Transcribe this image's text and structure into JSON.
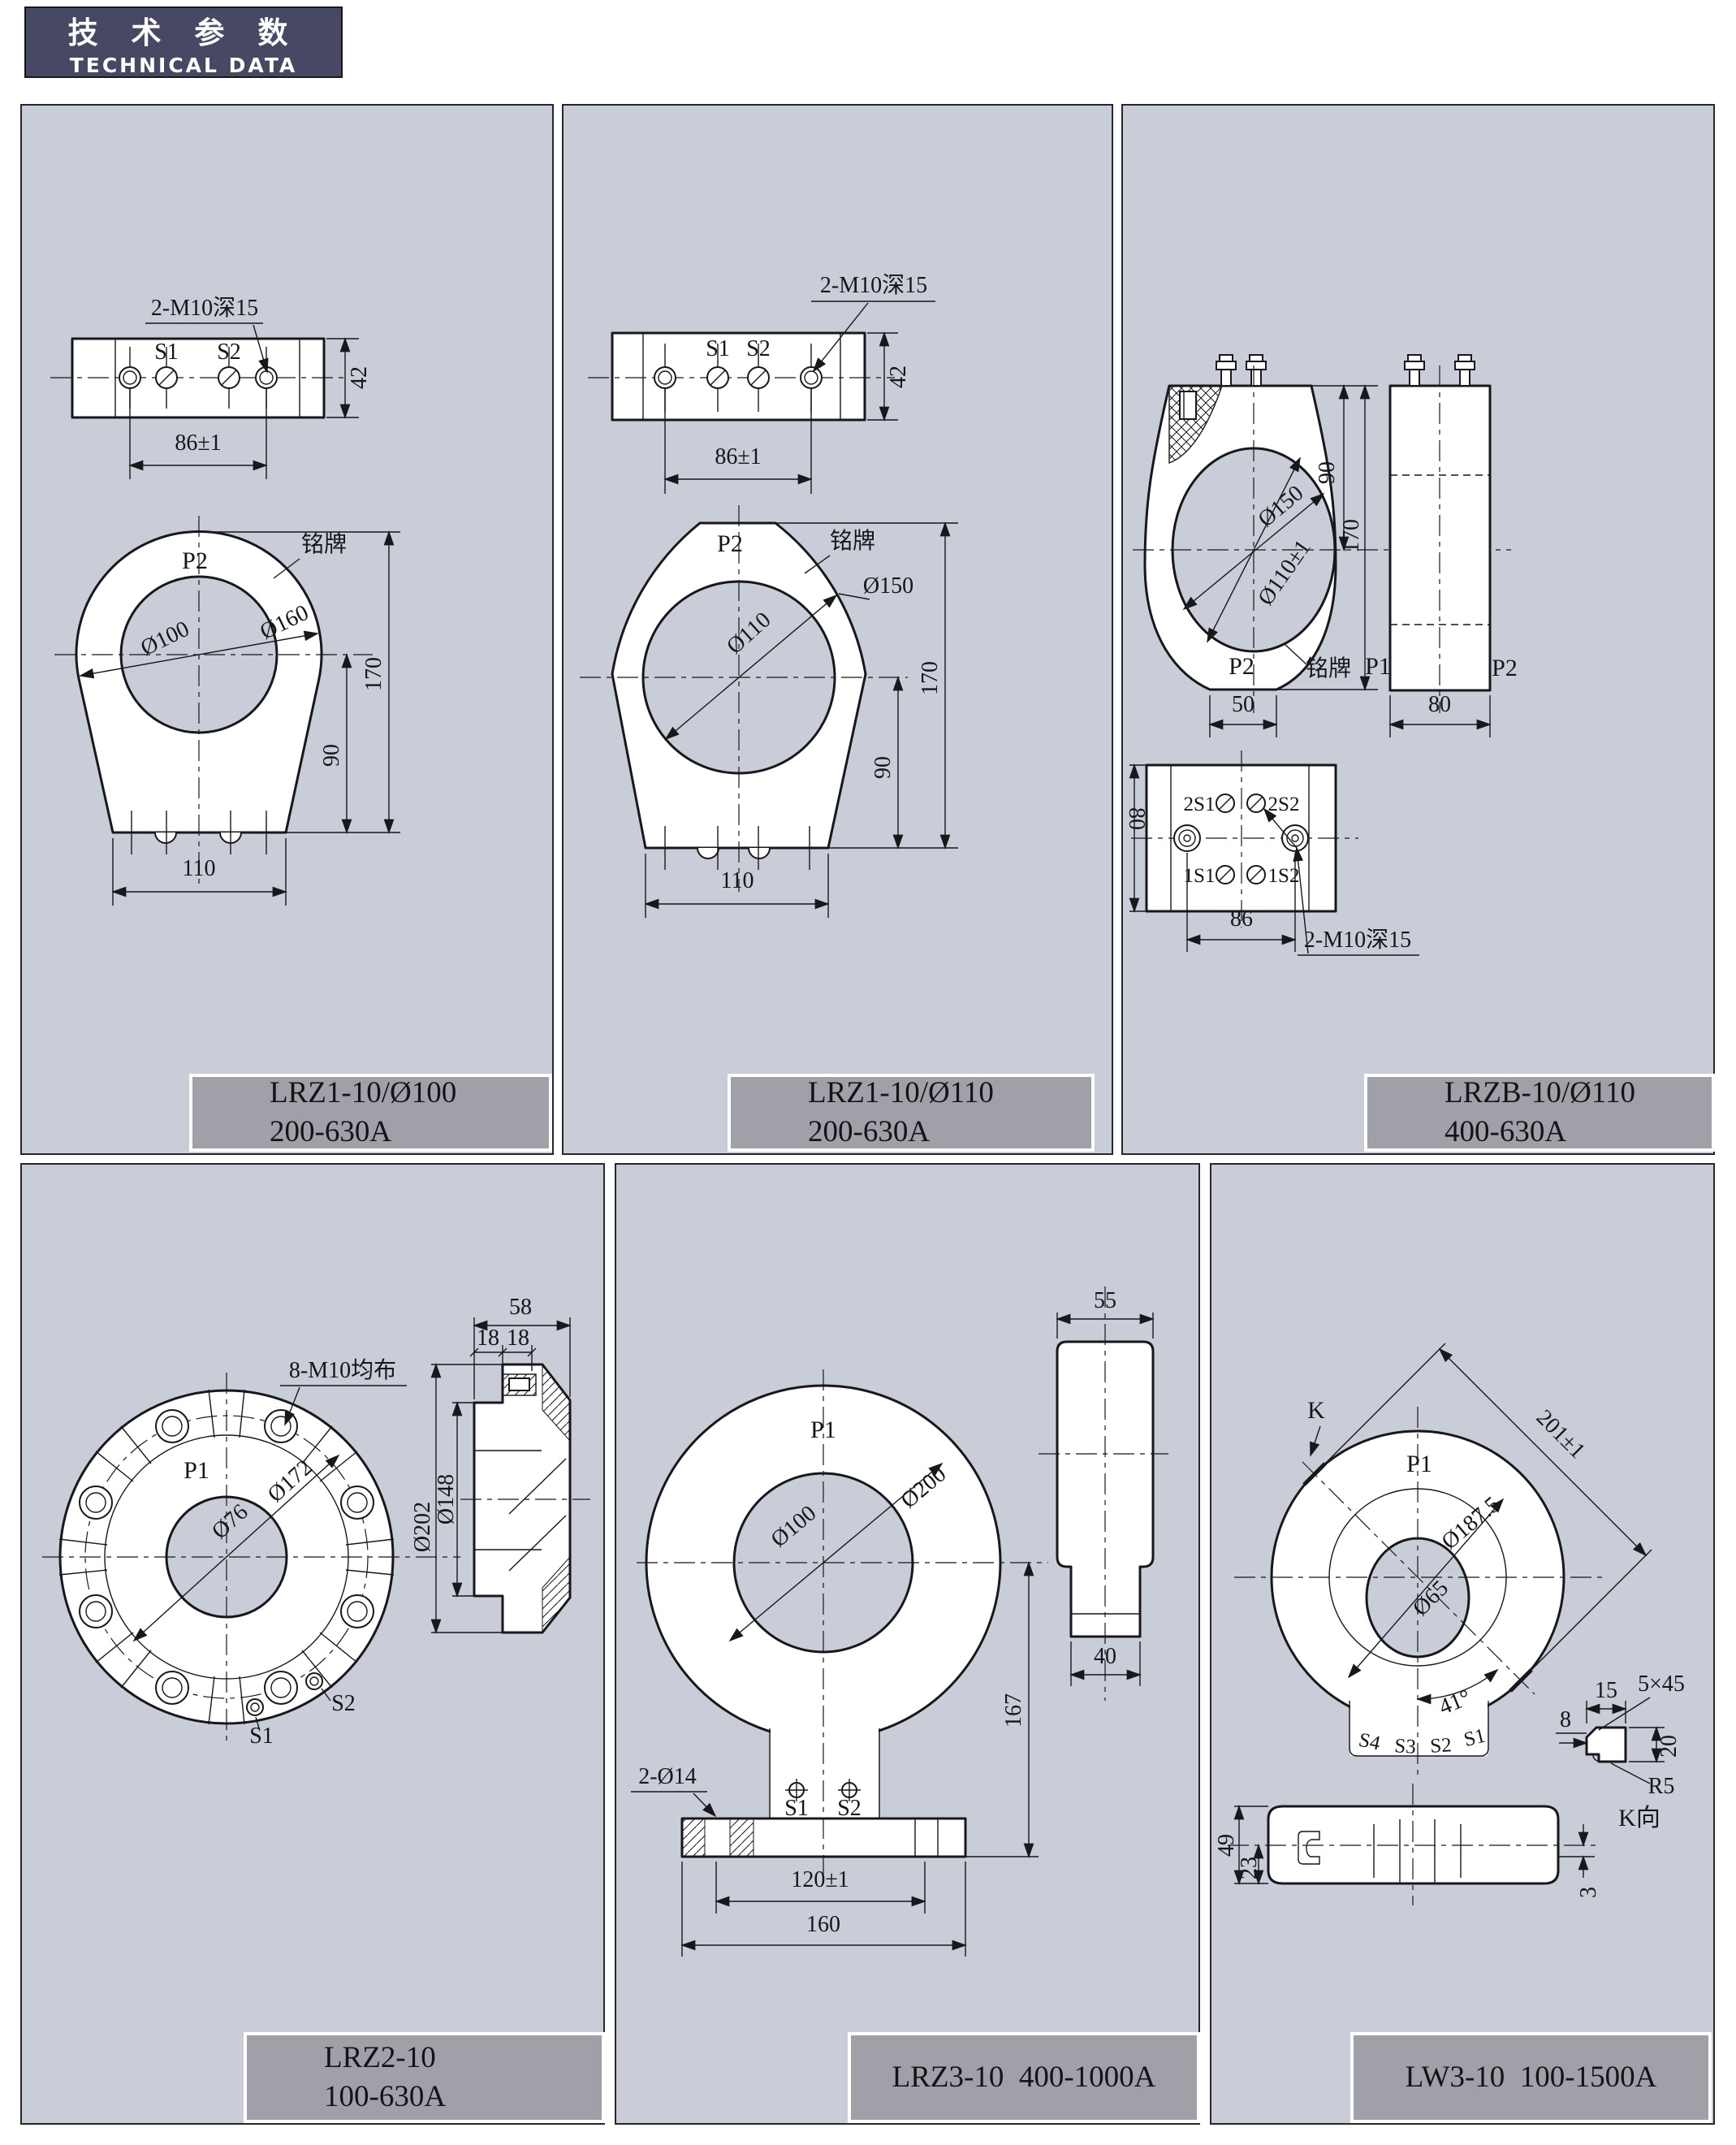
{
  "header": {
    "cn": "技 术 参 数",
    "en": "TECHNICAL DATA"
  },
  "colors": {
    "panel_bg": "#c9cdd7",
    "label_bg": "#9fa0a8",
    "header_bg": "#474863",
    "line": "#17171c"
  },
  "panels": [
    {
      "name": "LRZ1-10/Ø100",
      "label": {
        "l1": "LRZ1-10/Ø100",
        "l2": "200-630A"
      },
      "ann": {
        "thread": "2-M10深15",
        "s1": "S1",
        "s2": "S2",
        "d86": "86±1",
        "d42": "42",
        "p2": "P2",
        "plate": "铭牌",
        "dia1": "Ø100",
        "dia2": "Ø160",
        "d170": "170",
        "d90": "90",
        "d110": "110"
      }
    },
    {
      "name": "LRZ1-10/Ø110",
      "label": {
        "l1": "LRZ1-10/Ø110",
        "l2": "200-630A"
      },
      "ann": {
        "thread": "2-M10深15",
        "s1": "S1",
        "s2": "S2",
        "d86": "86±1",
        "d42": "42",
        "p2": "P2",
        "plate": "铭牌",
        "dia1": "Ø110",
        "dia2": "Ø150",
        "d170": "170",
        "d90": "90",
        "d110": "110"
      }
    },
    {
      "name": "LRZB-10/Ø110",
      "label": {
        "l1": "LRZB-10/Ø110",
        "l2": "400-630A"
      },
      "ann": {
        "d150": "Ø150",
        "d110": "Ø110±1",
        "d90": "90",
        "d170": "170",
        "d50": "50",
        "d80": "80",
        "p2": "P2",
        "plate": "铭牌",
        "p1": "P1",
        "p2b": "P2",
        "t2s1": "2S1",
        "t2s2": "2S2",
        "t1s1": "1S1",
        "t1s2": "1S2",
        "d80v": "80",
        "d86": "86",
        "thread": "2-M10深15"
      }
    },
    {
      "name": "LRZ2-10",
      "label": {
        "l1": "LRZ2-10",
        "l2": "100-630A"
      },
      "ann": {
        "bolts": "8-M10均布",
        "p1": "P1",
        "d76": "Ø76",
        "d172": "Ø172",
        "d202": "Ø202",
        "d148": "Ø148",
        "s1": "S1",
        "s2": "S2",
        "d58": "58",
        "d18a": "18",
        "d18b": "18"
      }
    },
    {
      "name": "LRZ3-10",
      "label": {
        "l1": "LRZ3-10  400-1000A"
      },
      "ann": {
        "p1": "P1",
        "d100": "Ø100",
        "d200": "Ø200",
        "d167": "167",
        "holes": "2-Ø14",
        "s1": "S1",
        "s2": "S2",
        "d120": "120±1",
        "d160": "160",
        "d55": "55",
        "d40": "40"
      }
    },
    {
      "name": "LW3-10",
      "label": {
        "l1": "LW3-10  100-1500A"
      },
      "ann": {
        "k": "K",
        "p1": "P1",
        "d201": "201±1",
        "d187": "Ø187.5",
        "d65": "Ø65",
        "a41": "41°",
        "s4": "S4",
        "s3": "S3",
        "s2": "S2",
        "s1": "S1",
        "d15": "15",
        "d8": "8",
        "ch": "5×45",
        "d20": "20",
        "r5": "R5",
        "kv": "K向",
        "d49": "49",
        "d23": "23",
        "d3": "3"
      }
    }
  ]
}
